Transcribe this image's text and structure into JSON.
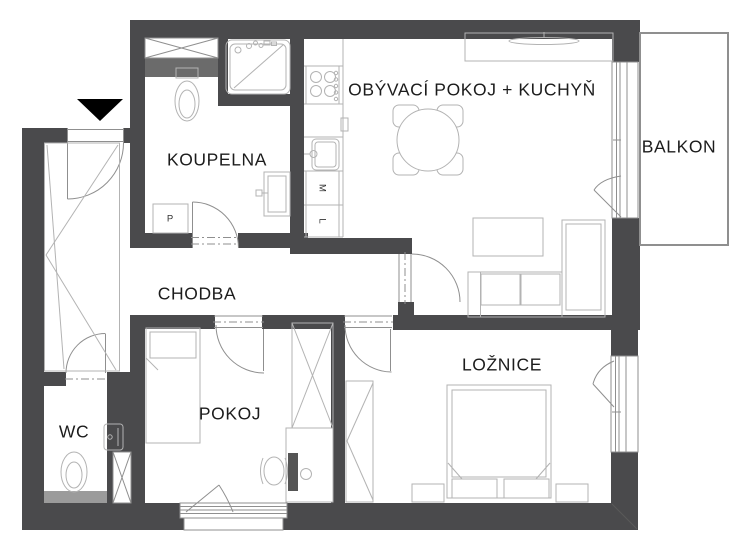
{
  "floorplan": {
    "labels": {
      "koupelna": "KOUPELNA",
      "obyvaci_kuchyn": "OBÝVACÍ POKOJ + KUCHYŇ",
      "balkon": "BALKON",
      "chodba": "CHODBA",
      "wc": "WC",
      "pokoj": "POKOJ",
      "loznice": "LOŽNICE",
      "pracka": "P",
      "mycka": "M",
      "lednice": "L"
    },
    "icons": {
      "entrance_arrow": "black triangle pointing down at entry door"
    },
    "colors": {
      "wall": "#4a4a4c",
      "wall_medium": "#6b6b6b",
      "wall_light": "#9b9b9b",
      "furniture_line": "#b3b3b3",
      "frame_line": "#8f8f8f",
      "text": "#1c1c1c",
      "background": "#ffffff",
      "arrow": "#000000",
      "monitor": "#555555"
    }
  }
}
